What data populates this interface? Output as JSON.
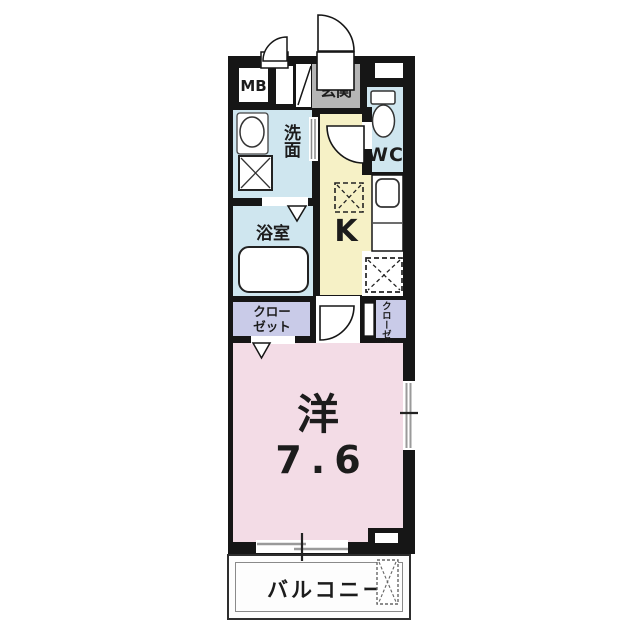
{
  "floorplan": {
    "background_color": "#ffffff",
    "wall_color": "#161616",
    "rooms": {
      "meter_box": {
        "label": "MB",
        "floor_color": "#ffffff"
      },
      "entrance": {
        "label": "玄関",
        "floor_color": "#b5b5b5"
      },
      "toilet": {
        "label": "WC",
        "floor_color": "#cfe6ef"
      },
      "washroom": {
        "label": "洗面",
        "floor_color": "#cfe6ef"
      },
      "bathroom": {
        "label": "浴室",
        "floor_color": "#cfe6ef"
      },
      "kitchen": {
        "label": "K",
        "floor_color": "#f6f1c6"
      },
      "closet_left": {
        "label": "クローゼット",
        "floor_color": "#c9cbe8"
      },
      "closet_right": {
        "label": "クローゼット",
        "floor_color": "#c9cbe8"
      },
      "main_room": {
        "label": "洋",
        "size_label": "7.6",
        "floor_color": "#f3dce6"
      },
      "balcony": {
        "label": "バルコニー",
        "floor_color": "#fdfdfd"
      }
    }
  }
}
